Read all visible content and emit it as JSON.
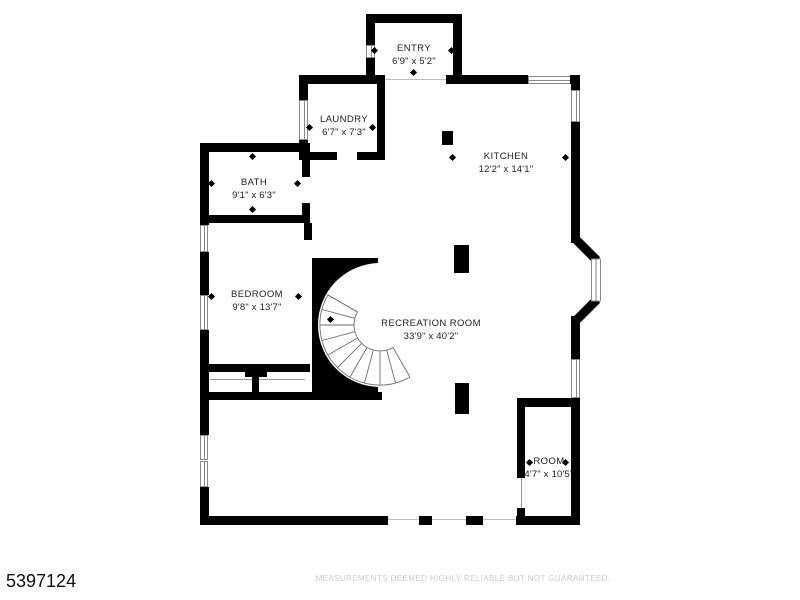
{
  "title": "First floor plan",
  "rooms": [
    {
      "name": "ENTRY",
      "dims": "6'9\" x 5'2\""
    },
    {
      "name": "LAUNDRY",
      "dims": "6'7\" x 7'3\""
    },
    {
      "name": "KITCHEN",
      "dims": "12'2\" x 14'1\""
    },
    {
      "name": "BATH",
      "dims": "9'1\" x 6'3\""
    },
    {
      "name": "BEDROOM",
      "dims": "9'8\" x 13'7\""
    },
    {
      "name": "RECREATION ROOM",
      "dims": "33'9\" x 40'2\""
    },
    {
      "name": "ROOM",
      "dims": "4'7\" x 10'5\""
    }
  ],
  "footer": {
    "listing_id": "5397124",
    "disclaimer": "MEASUREMENTS DEEMED HIGHLY RELIABLE BUT NOT GUARANTEED."
  },
  "colors": {
    "wall": "#000000",
    "floor": "#ffffff",
    "window_outline": "#8a8a8a",
    "disclaimer_text": "#cbcbcb"
  }
}
